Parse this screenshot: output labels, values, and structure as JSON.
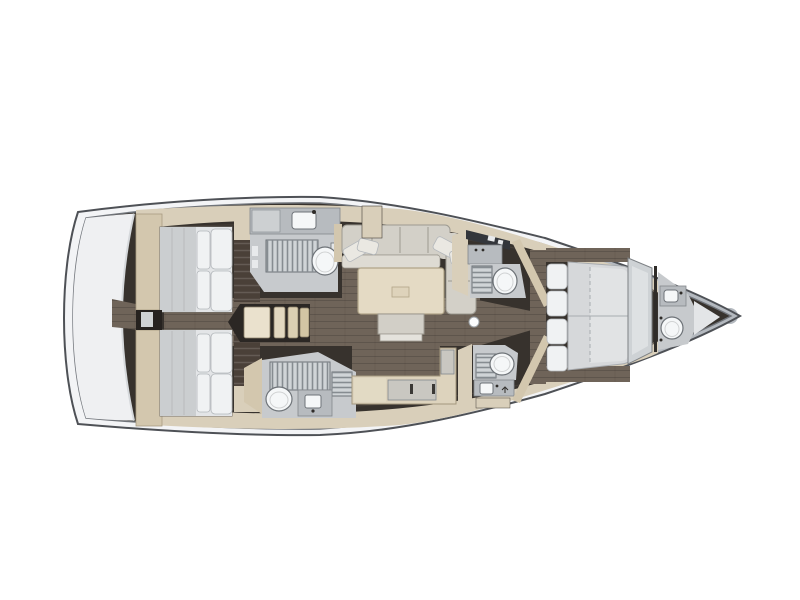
{
  "plan": {
    "vessel_label": "sailing-yacht-interior-layout-plan-top-view",
    "areas": [
      {
        "id": "stern-platform",
        "label": "stern platform"
      },
      {
        "id": "aft-cabin-upper",
        "label": "aft double cabin upper"
      },
      {
        "id": "aft-cabin-lower",
        "label": "aft double cabin lower"
      },
      {
        "id": "companionway-steps",
        "label": "companionway steps"
      },
      {
        "id": "wet-head-upper-aft",
        "label": "head with shower upper aft"
      },
      {
        "id": "wet-head-lower-aft",
        "label": "head with shower lower aft"
      },
      {
        "id": "saloon",
        "label": "saloon with sofa and table"
      },
      {
        "id": "galley-counter",
        "label": "galley counter"
      },
      {
        "id": "head-upper-mid",
        "label": "head upper mid"
      },
      {
        "id": "head-lower-mid",
        "label": "head lower mid"
      },
      {
        "id": "mast-step",
        "label": "mast step"
      },
      {
        "id": "forward-cabin",
        "label": "forward double cabin"
      },
      {
        "id": "forward-head",
        "label": "forward head"
      }
    ],
    "fixture_counts": {
      "double_berths": 3,
      "toilets": 5,
      "sinks": 5,
      "shower_grates": 5,
      "tables": 1
    }
  },
  "palette": {
    "bg": "#ffffff",
    "hull_rim": "#f3f4f6",
    "hull_stroke": "#4e5156",
    "inner_stroke": "#70747a",
    "rubrail": "#b4b9bf",
    "interior": "#37322d",
    "transom": "#eff0f2",
    "transom_edge": "#d5d8db",
    "band": "#d9cfba",
    "band_light": "#e3dac6",
    "band_shadow": "#474039",
    "headboard": "#d3c7ae",
    "headboard_stroke": "#a89c82",
    "wardrobe_brown": "#4a4038",
    "floor": "#6f6459",
    "stair_well": "#2b2724",
    "stair1": "#eae1cd",
    "stair2": "#e3d8c0",
    "stair3": "#dbcfb2",
    "stair4": "#d2c5a4",
    "stair_stroke": "#8c8068",
    "room_floor": "#c7cacd",
    "cabinet": "#b7bbbf",
    "cabinet_light": "#cdd0d2",
    "cabinet_stroke": "#83878c",
    "counter_dark": "#33363b",
    "grate_bg": "#d0d4d7",
    "grate_line": "#868c91",
    "grate_stroke": "#6d7277",
    "fixture": "#f5f7f8",
    "fixture_stroke": "#6e7378",
    "mattress": "#d6d8da",
    "mattress_side": "#cbced0",
    "mattress_light": "#e3e5e7",
    "mattress_stroke": "#76726c",
    "seam": "#a8acb0",
    "pillow": "#f0f2f3",
    "pillow_stroke": "#b3b7bb",
    "sofa": "#d3d0c8",
    "sofa_seat": "#dedbd3",
    "sofa_stroke": "#9d9a91",
    "cushion": "#eae8e2",
    "table": "#e4dac4",
    "table_stroke": "#b1a589",
    "table_inner": "#ded3bb",
    "ottoman": "#d2cfc7",
    "ottoman_base": "#e4e2dc",
    "galley": "#ddd3bd",
    "galley_stroke": "#a3977d",
    "galley_inset": "#c9c7c1",
    "handle": "#3a3835",
    "wardrobe_panel": "#ced2d5",
    "wardrobe_inner": "#dee1e3",
    "wardrobe_stroke": "#7d8185",
    "tip_light": "#e3e5e7",
    "divider_dark": "#26221f",
    "divider_light": "#cfd2d4",
    "mast": "#fbfcfd",
    "mast_stroke": "#9aa0a5",
    "detail_dark": "#2f2c29",
    "white_detail": "#e8eaec"
  }
}
